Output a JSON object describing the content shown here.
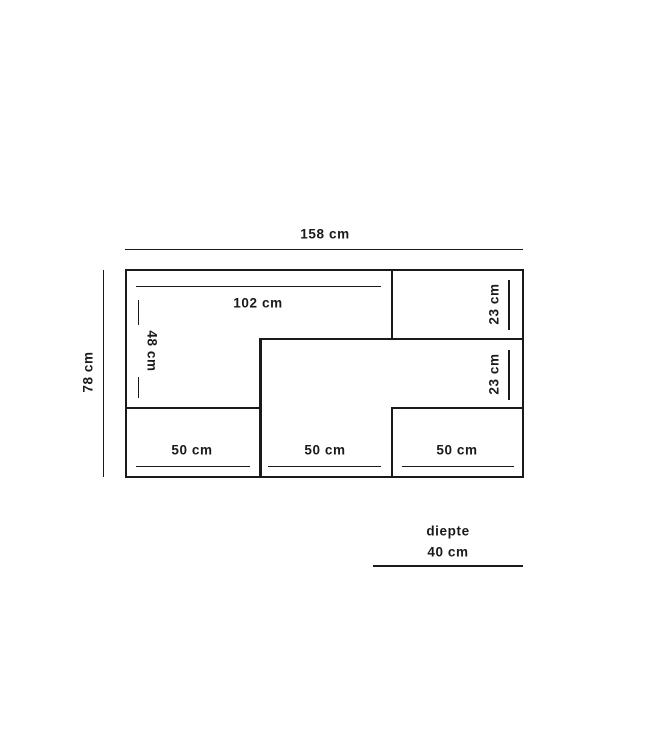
{
  "diagram": {
    "overall": {
      "width_label": "158 cm",
      "height_label": "78 cm"
    },
    "compartments": {
      "top_shelf_label": "102 cm",
      "left_height_label": "48 cm",
      "top_right_label": "23 cm",
      "middle_right_label": "23 cm",
      "bottom_labels": [
        "50 cm",
        "50 cm",
        "50 cm"
      ]
    },
    "depth": {
      "label": "diepte",
      "value": "40 cm"
    },
    "colors": {
      "line": "#1a1a1a",
      "background": "#ffffff"
    }
  }
}
